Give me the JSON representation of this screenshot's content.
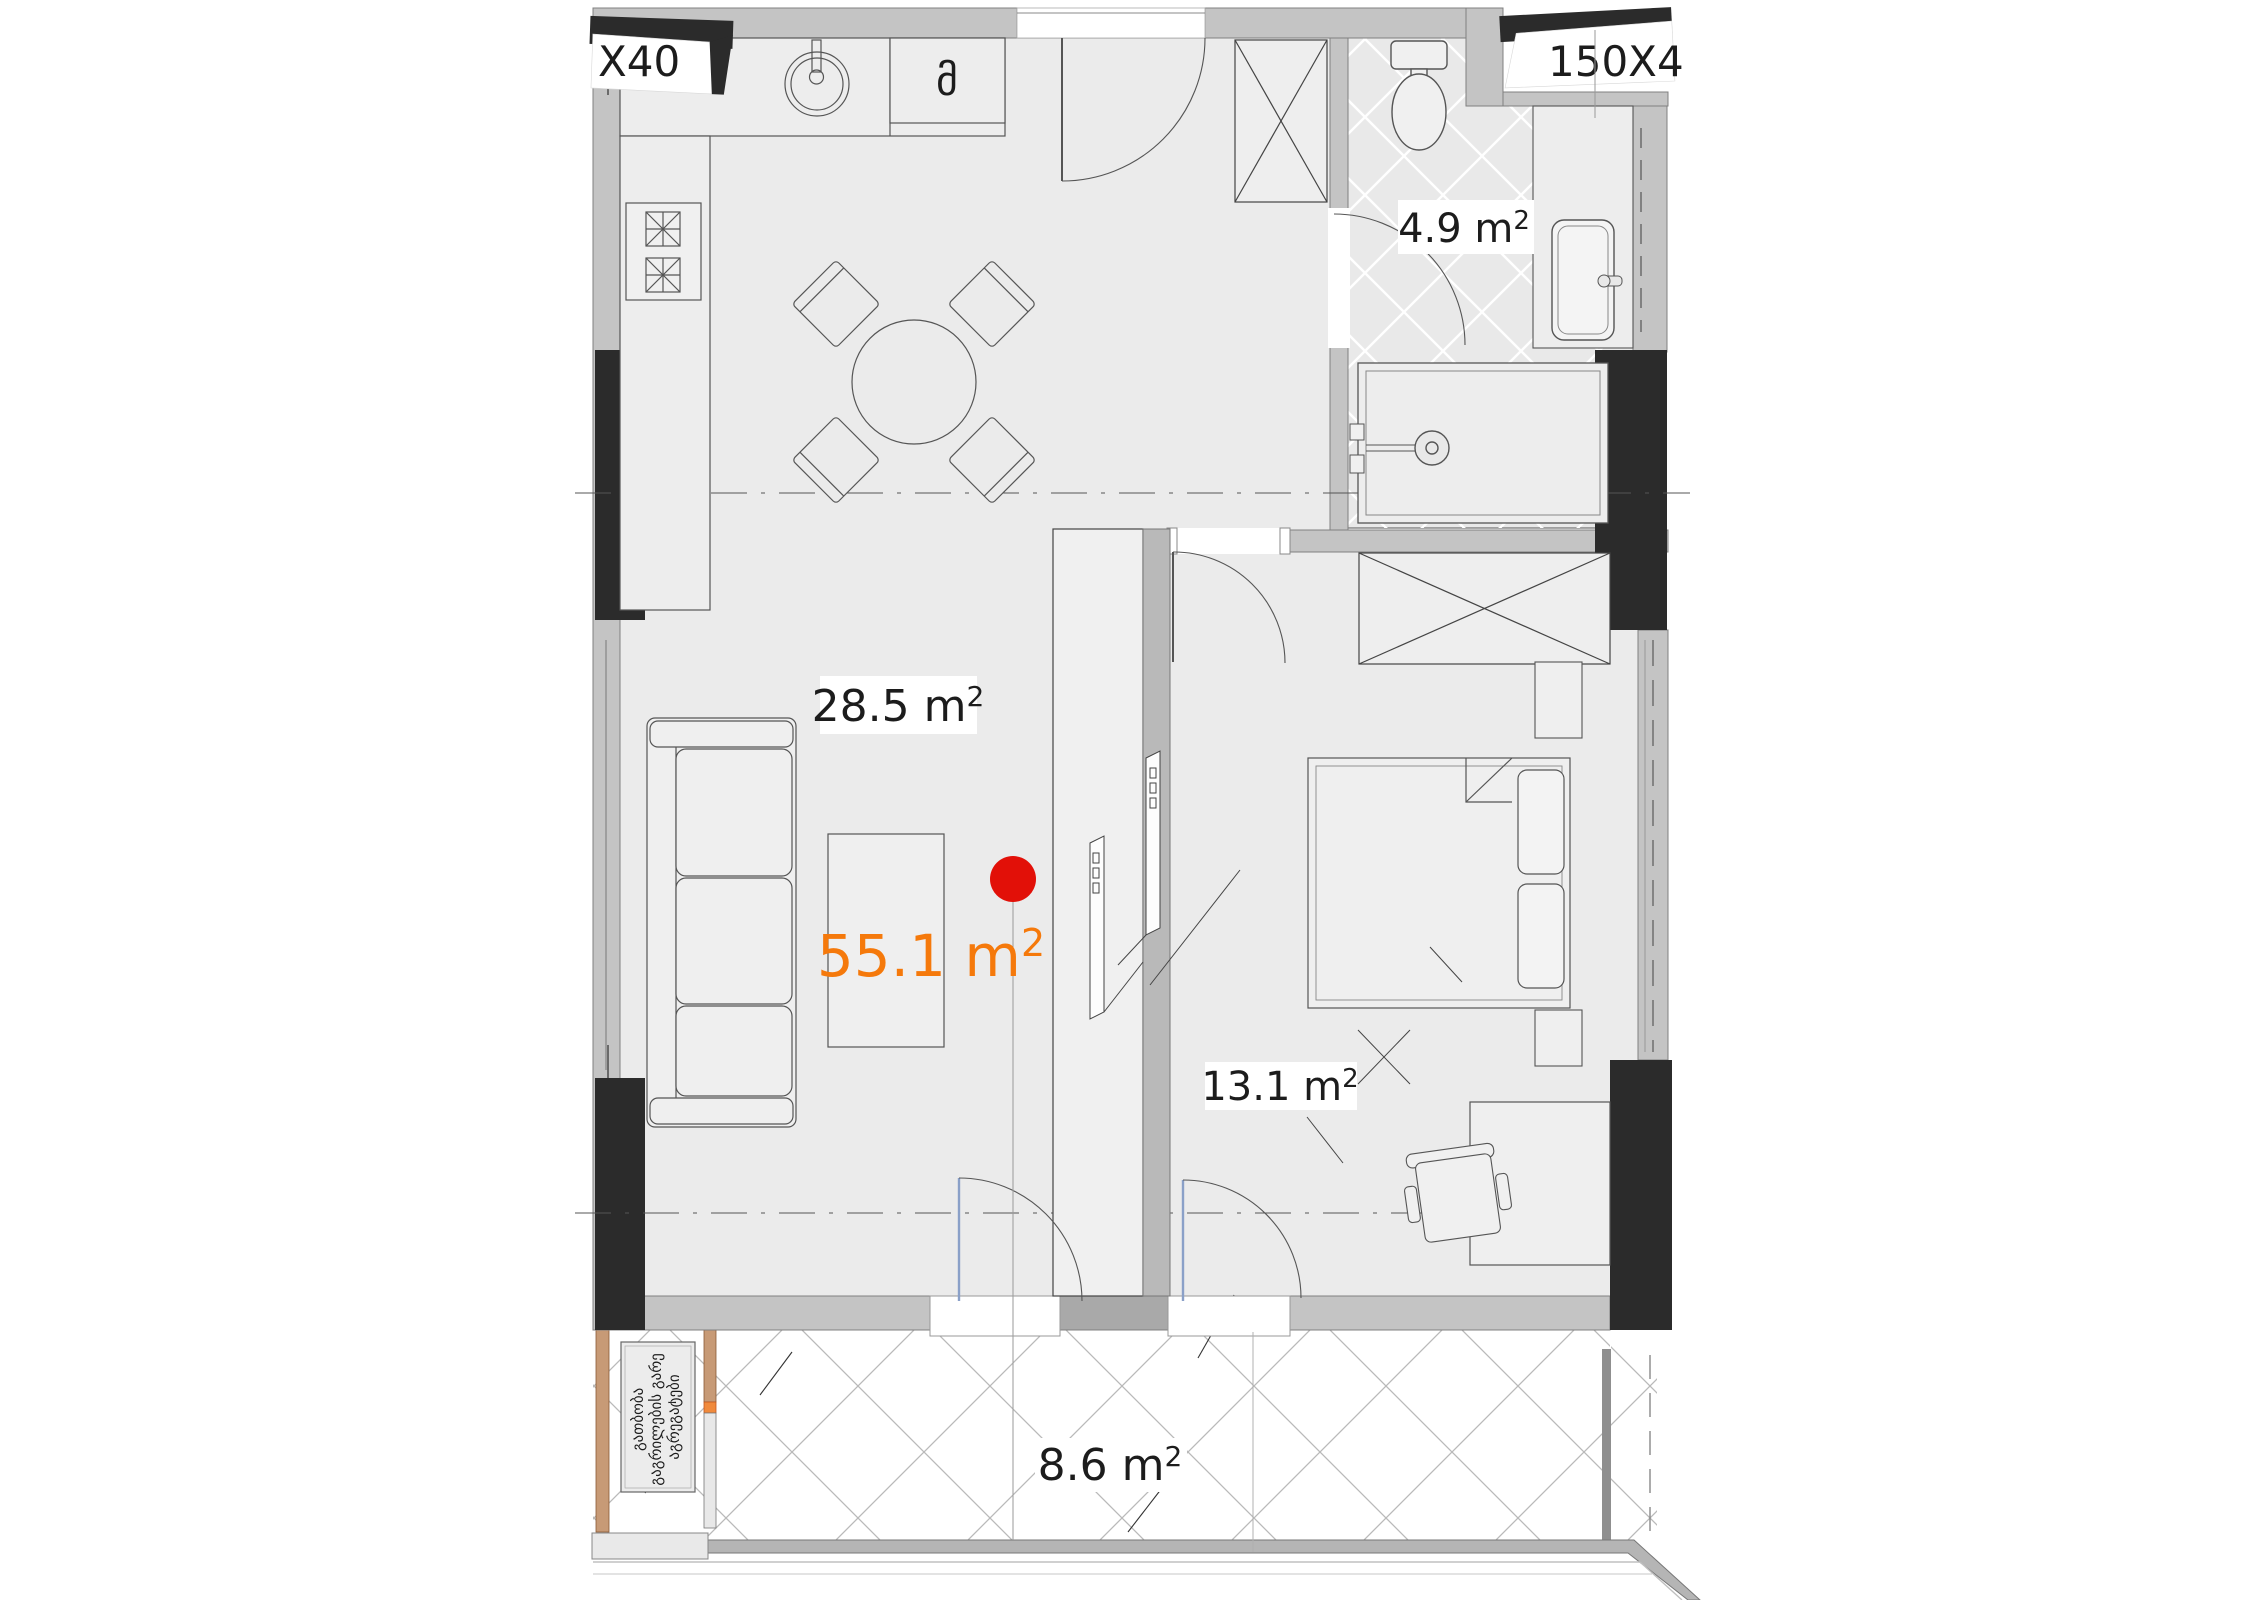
{
  "plan": {
    "title": "apartment-floor-plan",
    "window_tag_left": "X40",
    "window_tag_right": "150X4",
    "kitchen_appliance_symbol": "მ",
    "rooms": {
      "living": {
        "label": "28.5 m",
        "sup": "2"
      },
      "bathroom": {
        "label": "4.9 m",
        "sup": "2"
      },
      "bedroom": {
        "label": "13.1 m",
        "sup": "2"
      },
      "balcony": {
        "label": "8.6 m",
        "sup": "2"
      },
      "total": {
        "label": "55.1 m",
        "sup": "2"
      }
    },
    "balcony_note": {
      "line1": "გათბობა",
      "line2": "გაგრილების გარე",
      "line3": "აგრეგატები"
    },
    "colors": {
      "total_accent": "#F5790B",
      "marker_red": "#E21008",
      "wall_gray": "#C4C4C4",
      "column_black": "#2B2B2B",
      "floor": "#EBEBEB",
      "tan": "#C79A76",
      "orange_connector": "#F08A3C"
    }
  }
}
